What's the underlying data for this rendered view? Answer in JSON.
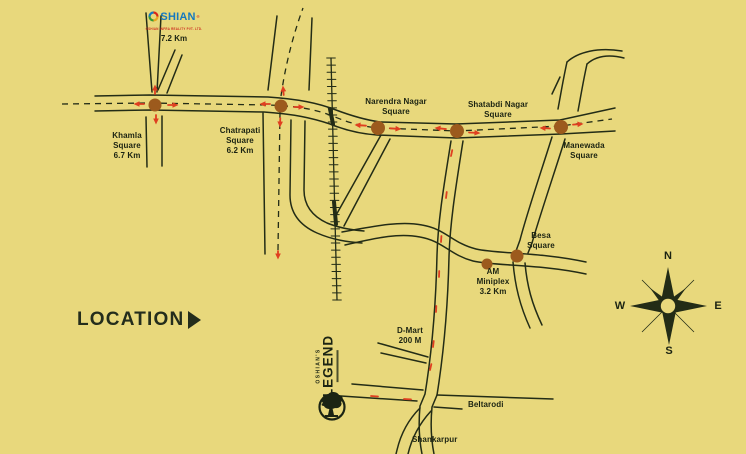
{
  "colors": {
    "background": "#e8d87c",
    "road": "#232c16",
    "text": "#1b2312",
    "dot": "#9c5a1d",
    "arrow": "#df3f20",
    "brand_blue": "#1478c0",
    "brand_red": "#cc2a1e"
  },
  "brand": {
    "logo_rest": "SHIAN",
    "registered": "®",
    "tagline": "OSHIAN INFRA REALITY PVT. LTD.",
    "distance": "7.2 Km"
  },
  "location": {
    "label": "LOCATION"
  },
  "project": {
    "pre": "OSHIAN'S",
    "name": "LEGEND"
  },
  "compass": {
    "n": "N",
    "e": "E",
    "s": "S",
    "w": "W"
  },
  "map": {
    "labels": [
      {
        "id": "khamla-square",
        "lines": [
          "Khamla",
          "Square",
          "6.7 Km"
        ],
        "x": 127,
        "y": 146
      },
      {
        "id": "chatrapati-square",
        "lines": [
          "Chatrapati",
          "Square",
          "6.2 Km"
        ],
        "x": 240,
        "y": 141
      },
      {
        "id": "narendra-nagar-square",
        "lines": [
          "Narendra Nagar",
          "Square"
        ],
        "x": 396,
        "y": 107
      },
      {
        "id": "shatabdi-nagar-square",
        "lines": [
          "Shatabdi Nagar",
          "Square"
        ],
        "x": 498,
        "y": 110
      },
      {
        "id": "manewada-square",
        "lines": [
          "Manewada",
          "Square"
        ],
        "x": 584,
        "y": 151
      },
      {
        "id": "besa-square",
        "lines": [
          "Besa",
          "Square"
        ],
        "x": 541,
        "y": 241
      },
      {
        "id": "am-miniplex",
        "lines": [
          "AM",
          "Miniplex",
          "3.2 Km"
        ],
        "x": 493,
        "y": 282
      },
      {
        "id": "d-mart",
        "lines": [
          "D-Mart",
          "200 M"
        ],
        "x": 410,
        "y": 336
      },
      {
        "id": "beltarodi",
        "lines": [
          "Beltarodi"
        ],
        "x": 468,
        "y": 405,
        "anchor": "left"
      },
      {
        "id": "shankarpur",
        "lines": [
          "Shankarpur"
        ],
        "x": 412,
        "y": 440,
        "anchor": "left"
      }
    ],
    "dots": [
      {
        "id": "khamla",
        "x": 155,
        "y": 105,
        "r": 6.5
      },
      {
        "id": "chatrapati",
        "x": 281,
        "y": 106,
        "r": 6.5
      },
      {
        "id": "narendra-nagar",
        "x": 378,
        "y": 128,
        "r": 7
      },
      {
        "id": "shatabdi-nagar",
        "x": 457,
        "y": 131,
        "r": 7
      },
      {
        "id": "manewada",
        "x": 561,
        "y": 127,
        "r": 7
      },
      {
        "id": "besa",
        "x": 517,
        "y": 256,
        "r": 6.5
      },
      {
        "id": "am-miniplex",
        "x": 487,
        "y": 264,
        "r": 5.5
      }
    ],
    "arrows": [
      {
        "id": "khamla-left",
        "x": 135,
        "y": 104,
        "a": 180,
        "len": 9,
        "head": true
      },
      {
        "id": "khamla-right",
        "x": 177,
        "y": 105,
        "a": 0,
        "len": 9,
        "head": true
      },
      {
        "id": "khamla-up",
        "x": 155,
        "y": 86,
        "a": 270,
        "len": 8,
        "head": true
      },
      {
        "id": "khamla-down",
        "x": 156,
        "y": 123,
        "a": 90,
        "len": 8,
        "head": true
      },
      {
        "id": "chatrapati-left",
        "x": 261,
        "y": 104,
        "a": 180,
        "len": 9,
        "head": true
      },
      {
        "id": "chatrapati-right",
        "x": 303,
        "y": 107,
        "a": 0,
        "len": 9,
        "head": true
      },
      {
        "id": "chatrapati-up",
        "x": 283,
        "y": 87,
        "a": 265,
        "len": 8,
        "head": true
      },
      {
        "id": "chatrapati-down",
        "x": 280,
        "y": 126,
        "a": 92,
        "len": 8,
        "head": true
      },
      {
        "id": "narendra-left",
        "x": 356,
        "y": 125,
        "a": 184,
        "len": 10,
        "head": true
      },
      {
        "id": "narendra-right",
        "x": 400,
        "y": 129,
        "a": 4,
        "len": 10,
        "head": true
      },
      {
        "id": "shatabdi-left",
        "x": 436,
        "y": 128,
        "a": 186,
        "len": 10,
        "head": true
      },
      {
        "id": "shatabdi-right",
        "x": 479,
        "y": 133,
        "a": 3,
        "len": 10,
        "head": true
      },
      {
        "id": "manewada-left",
        "x": 541,
        "y": 128,
        "a": 183,
        "len": 9,
        "head": true
      },
      {
        "id": "manewada-right",
        "x": 582,
        "y": 124,
        "a": -4,
        "len": 9,
        "head": true
      },
      {
        "id": "route-1",
        "x": 451,
        "y": 156,
        "a": 102,
        "len": 6,
        "head": false
      },
      {
        "id": "route-2",
        "x": 446,
        "y": 198,
        "a": 97,
        "len": 6,
        "head": false
      },
      {
        "id": "route-3",
        "x": 441,
        "y": 242,
        "a": 94,
        "len": 6,
        "head": false
      },
      {
        "id": "route-4",
        "x": 439,
        "y": 277,
        "a": 92,
        "len": 6,
        "head": false
      },
      {
        "id": "route-5",
        "x": 436,
        "y": 312,
        "a": 93,
        "len": 6,
        "head": false
      },
      {
        "id": "route-6",
        "x": 433,
        "y": 347,
        "a": 97,
        "len": 6,
        "head": false
      },
      {
        "id": "route-7",
        "x": 430,
        "y": 370,
        "a": 103,
        "len": 6,
        "head": false
      },
      {
        "id": "route-8",
        "x": 404,
        "y": 399,
        "a": 183,
        "len": 7,
        "head": false
      },
      {
        "id": "route-9",
        "x": 371,
        "y": 396,
        "a": 184,
        "len": 7,
        "head": false
      },
      {
        "id": "chatrapati-south-end",
        "x": 278,
        "y": 258,
        "a": 90,
        "len": 7,
        "head": true
      }
    ]
  }
}
